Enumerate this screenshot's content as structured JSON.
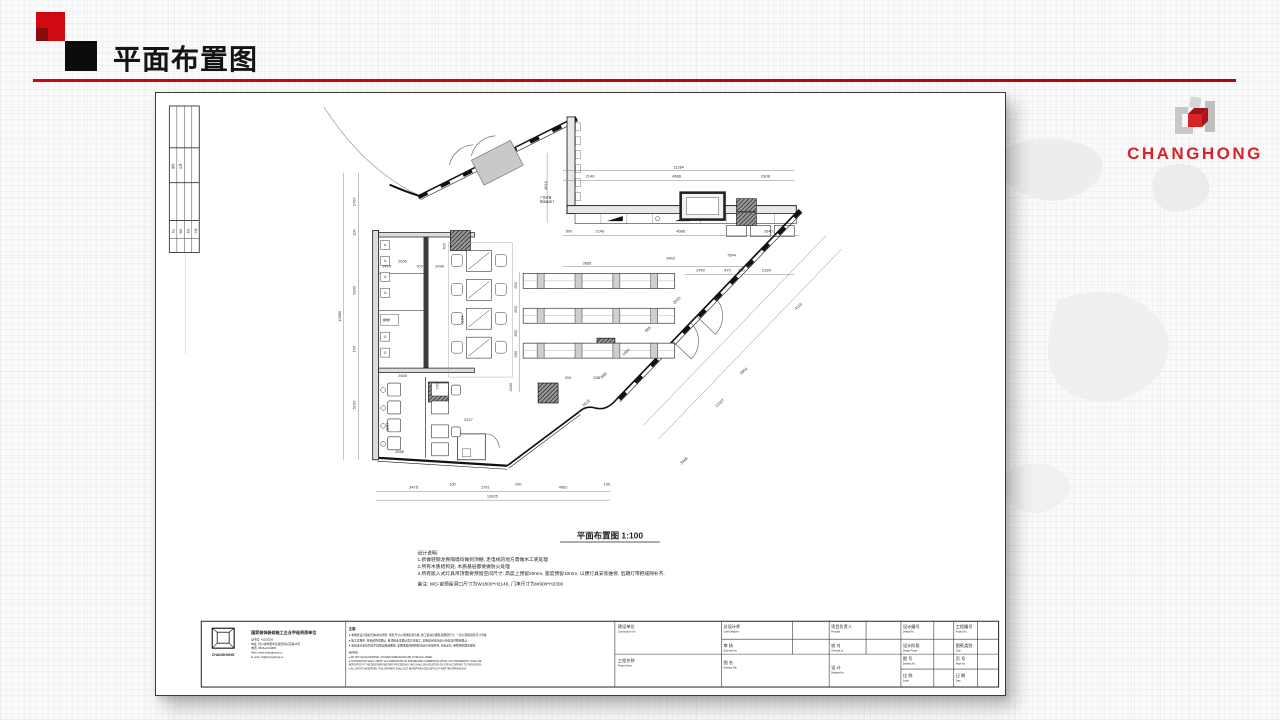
{
  "slide": {
    "title": "平面布置图",
    "accent_color": "#c40a10",
    "brand": {
      "name": "CHANGHONG",
      "color": "#d8232a"
    }
  },
  "sheet": {
    "plan_title": "平面布置图 1:100",
    "design_notes": [
      "设计说明:",
      "1.新做轻钢龙骨隔墙均做到顶棚, 走电线的地方需做木工底处理",
      "2.所有木质结构处, 木质基层都要做防火处理",
      "3.所有嵌入式灯具吊顶需要预留空间尺寸: 高度上预留20mm, 宽度预留10mm, 以便灯具安装维修, 后期灯带把缝隙补齐.",
      "备注: WD-窗预留洞口尺寸为W1800*H2146, 门净尺寸为W900*H2300"
    ],
    "dimensions": [
      {
        "t": "11284",
        "x": 524,
        "y": 76
      },
      {
        "t": "2140",
        "x": 435,
        "y": 85
      },
      {
        "t": "4686",
        "x": 522,
        "y": 85
      },
      {
        "t": "2308",
        "x": 611,
        "y": 85
      },
      {
        "t": "500",
        "x": 414,
        "y": 140
      },
      {
        "t": "2140",
        "x": 445,
        "y": 140
      },
      {
        "t": "4686",
        "x": 526,
        "y": 140
      },
      {
        "t": "2640",
        "x": 614,
        "y": 140
      },
      {
        "t": "4614",
        "x": 392,
        "y": 93,
        "r": -90
      },
      {
        "t": "13880",
        "x": 185,
        "y": 224,
        "r": -90
      },
      {
        "t": "2767",
        "x": 200,
        "y": 109,
        "r": -90
      },
      {
        "t": "100",
        "x": 200,
        "y": 140,
        "r": -90
      },
      {
        "t": "5393",
        "x": 200,
        "y": 198,
        "r": -90
      },
      {
        "t": "100",
        "x": 200,
        "y": 257,
        "r": -90
      },
      {
        "t": "5150",
        "x": 200,
        "y": 313,
        "r": -90
      },
      {
        "t": "3475",
        "x": 258,
        "y": 397
      },
      {
        "t": "100",
        "x": 297,
        "y": 394
      },
      {
        "t": "2791",
        "x": 330,
        "y": 397
      },
      {
        "t": "100",
        "x": 363,
        "y": 394
      },
      {
        "t": "4062",
        "x": 408,
        "y": 397
      },
      {
        "t": "100",
        "x": 452,
        "y": 394
      },
      {
        "t": "11625",
        "x": 337,
        "y": 406
      },
      {
        "t": "2414",
        "x": 231,
        "y": 175
      },
      {
        "t": "2600",
        "x": 247,
        "y": 170
      },
      {
        "t": "700",
        "x": 264,
        "y": 175
      },
      {
        "t": "1096",
        "x": 284,
        "y": 175
      },
      {
        "t": "700",
        "x": 290,
        "y": 154,
        "r": -90
      },
      {
        "t": "3685",
        "x": 432,
        "y": 172
      },
      {
        "t": "3402",
        "x": 516,
        "y": 167
      },
      {
        "t": "7544",
        "x": 577,
        "y": 164
      },
      {
        "t": "2400",
        "x": 546,
        "y": 179
      },
      {
        "t": "470",
        "x": 573,
        "y": 179
      },
      {
        "t": "700",
        "x": 587,
        "y": 179
      },
      {
        "t": "2189",
        "x": 612,
        "y": 179
      },
      {
        "t": "650",
        "x": 362,
        "y": 193,
        "r": -90
      },
      {
        "t": "800",
        "x": 362,
        "y": 217,
        "r": -90
      },
      {
        "t": "800",
        "x": 362,
        "y": 241,
        "r": -90
      },
      {
        "t": "650",
        "x": 362,
        "y": 262,
        "r": -90
      },
      {
        "t": "2160",
        "x": 357,
        "y": 295,
        "r": -90
      },
      {
        "t": "6194",
        "x": 308,
        "y": 228,
        "r": -90
      },
      {
        "t": "2600",
        "x": 247,
        "y": 285
      },
      {
        "t": "700",
        "x": 283,
        "y": 294,
        "r": -90
      },
      {
        "t": "200",
        "x": 413,
        "y": 287
      },
      {
        "t": "5387",
        "x": 443,
        "y": 287
      },
      {
        "t": "2227",
        "x": 313,
        "y": 329
      },
      {
        "t": "1187",
        "x": 233,
        "y": 335,
        "r": -90
      },
      {
        "t": "2555",
        "x": 244,
        "y": 361
      },
      {
        "t": "960",
        "x": 450,
        "y": 284,
        "r": -42
      },
      {
        "t": "1450",
        "x": 472,
        "y": 261,
        "r": -42
      },
      {
        "t": "985",
        "x": 494,
        "y": 238,
        "r": -42
      },
      {
        "t": "2533",
        "x": 523,
        "y": 209,
        "r": -42
      },
      {
        "t": "3619",
        "x": 432,
        "y": 312,
        "r": -42
      },
      {
        "t": "3448",
        "x": 530,
        "y": 370,
        "r": -42
      },
      {
        "t": "11027",
        "x": 566,
        "y": 312,
        "r": -42
      },
      {
        "t": "3504",
        "x": 590,
        "y": 280,
        "r": -42
      },
      {
        "t": "4119",
        "x": 645,
        "y": 215,
        "r": -42
      }
    ],
    "annotations": [
      {
        "t": "修改",
        "x": 17.5,
        "y": 76,
        "r": -90,
        "s": 2.6
      },
      {
        "t": "记录",
        "x": 25,
        "y": 76,
        "r": -90,
        "s": 2.6
      },
      {
        "t": "专业",
        "x": 17.5,
        "y": 141,
        "r": -90,
        "s": 2.5
      },
      {
        "t": "姓名",
        "x": 25,
        "y": 141,
        "r": -90,
        "s": 2.5
      },
      {
        "t": "签名",
        "x": 32.5,
        "y": 141,
        "r": -90,
        "s": 2.5
      },
      {
        "t": "日期",
        "x": 40,
        "y": 141,
        "r": -90,
        "s": 2.5
      },
      {
        "t": "广告灯箱",
        "x": 385,
        "y": 106,
        "s": 2.8
      },
      {
        "t": "玻璃自动门",
        "x": 385,
        "y": 110,
        "s": 2.8
      },
      {
        "t": "储物柜",
        "x": 227,
        "y": 229,
        "s": 2.6
      }
    ],
    "title_block": {
      "qualification": "国家装饰装修施工企业甲级资质单位",
      "company_info": [
        "证书号: 41100236",
        "地址: 四川省绵阳市高新区绵兴东路35号",
        "电话: 0816-2410305",
        "Web: www.changhong.cc",
        "E-mail: ch@changhong.cc"
      ],
      "notice_title": "注意:",
      "notices": [
        "● 本图纸设计版权归本单位所有, 所有尺寸以现场实测为准, 施工前请仔细核对图纸尺寸, 一切以现场实际尺寸为准.",
        "● 施工过程中, 材料颜色需确认, 且须经业主确认后方可施工, 如有疑问请与设计单位及时联系确认.",
        "● 未经设计单位同意不得擅自修改图纸, 本图纸最终解释权归设计单位所有, 违者必究, 参照相关国家规范."
      ],
      "notes_en_title": "NOTES:",
      "notes_en": [
        "● DO NOT SCALE DRAWING, FIGURED DIMENSIONS ARE TO BE FOLLOWED.",
        "● CONTRACTOR SHALL VERIFY ALL DIMENSIONS ON SITE BEFORE COMMENCING WORK, ANY DISCREPANCY SHALL BE",
        "   REPORTED TO THE DESIGNER BEFORE PROCEEDING, AND SHALL BE ADJUSTED ON SITE ACCORDING TO THE DESIGN.",
        "● ALL RIGHTS RESERVED. THIS DRAWING SHALL NOT BE REPRODUCED WITHOUT WRITTEN PERMISSION."
      ],
      "fields": [
        {
          "cn": "建设单位",
          "en": "Construction Unit",
          "x": 463,
          "y": 537
        },
        {
          "cn": "工程名称",
          "en": "Project Name",
          "x": 463,
          "y": 571
        },
        {
          "cn": "总设计师",
          "en": "Chief Designer",
          "x": 569,
          "y": 537
        },
        {
          "cn": "审  核",
          "en": "Examined by",
          "x": 569,
          "y": 556
        },
        {
          "cn": "图  名",
          "en": "Drawing Title",
          "x": 569,
          "y": 573
        },
        {
          "cn": "项目负责人",
          "en": "Principal",
          "x": 677,
          "y": 537
        },
        {
          "cn": "校  对",
          "en": "Checked by",
          "x": 677,
          "y": 556
        },
        {
          "cn": "设  计",
          "en": "Designed by",
          "x": 677,
          "y": 578
        },
        {
          "cn": "设计编号",
          "en": "Design No.",
          "x": 749,
          "y": 537
        },
        {
          "cn": "设计阶段",
          "en": "Design Phase",
          "x": 749,
          "y": 556
        },
        {
          "cn": "图  号",
          "en": "Drawing No.",
          "x": 749,
          "y": 569
        },
        {
          "cn": "比  例",
          "en": "Scale",
          "x": 749,
          "y": 586
        },
        {
          "cn": "工程编号",
          "en": "Project No.",
          "x": 802,
          "y": 537
        },
        {
          "cn": "图纸类别",
          "en": "Type",
          "x": 802,
          "y": 556
        },
        {
          "cn": "页  号",
          "en": "Page No.",
          "x": 802,
          "y": 569
        },
        {
          "cn": "日  期",
          "en": "Date",
          "x": 802,
          "y": 586
        }
      ]
    }
  }
}
